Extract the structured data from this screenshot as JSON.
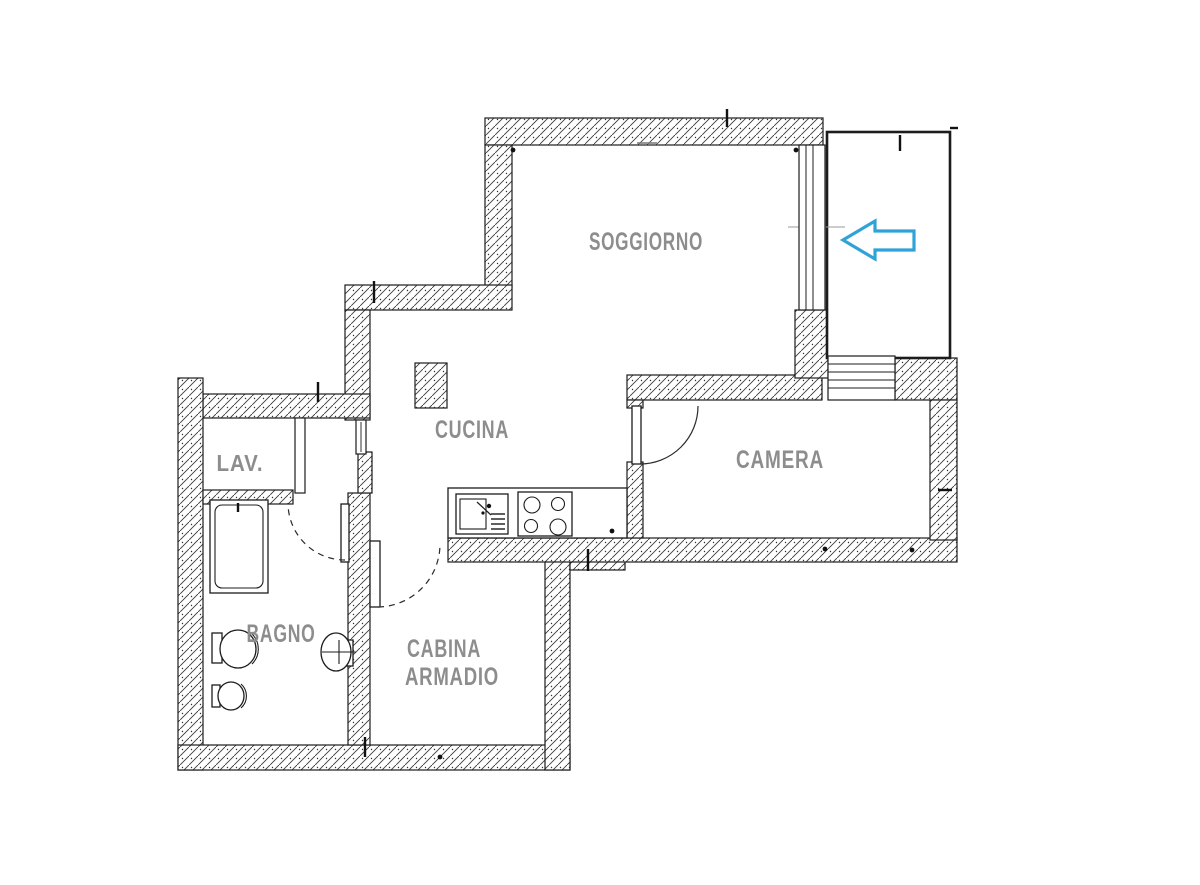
{
  "floor_plan": {
    "rooms": {
      "soggiorno": {
        "label": "SOGGIORNO"
      },
      "cucina": {
        "label": "CUCINA"
      },
      "camera": {
        "label": "CAMERA"
      },
      "lav": {
        "label": "LAV."
      },
      "bagno": {
        "label": "BAGNO"
      },
      "cabina_armadio": {
        "line1": "CABINA",
        "line2": "ARMADIO"
      }
    },
    "entrance_arrow": {
      "direction": "left",
      "color": "#2fa3d7"
    },
    "colors": {
      "label_text": "#8d8d8d",
      "wall_outline": "#1c1c1c",
      "background": "#ffffff"
    },
    "fixtures": [
      "bathtub",
      "toilet",
      "bidet",
      "washbasin",
      "kitchen-sink",
      "cooktop",
      "column"
    ]
  }
}
